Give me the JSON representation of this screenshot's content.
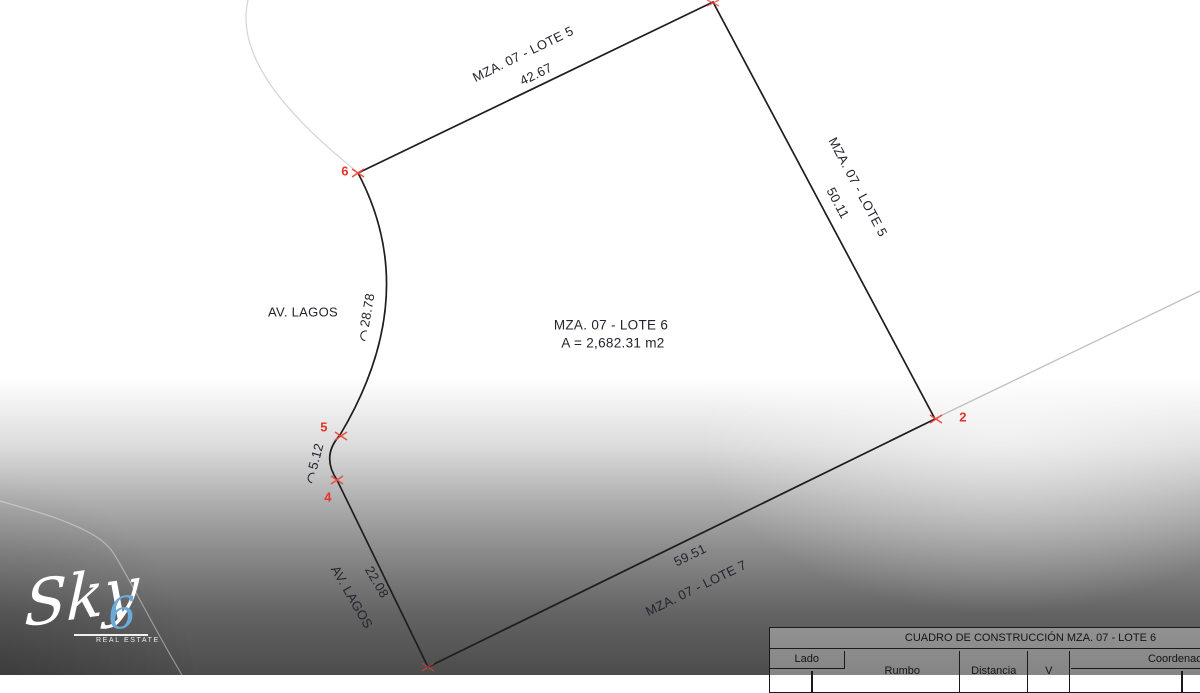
{
  "drawing": {
    "lot_title": "MZA. 07 - LOTE 6",
    "lot_area": "A = 2,682.31 m2",
    "top": {
      "neighbor": "MZA. 07 - LOTE 5",
      "length": "42.67"
    },
    "right": {
      "neighbor": "MZA. 07 - LOTE 5",
      "length": "50.11"
    },
    "bottom": {
      "neighbor": "MZA. 07 - LOTE 7",
      "length": "59.51"
    },
    "street_upper": "AV. LAGOS",
    "street_lower": "AV. LAGOS",
    "curve_length_upper": "28.78",
    "curve_length_lower": "5.12",
    "segment_length": "22.08",
    "vertices": {
      "v6": "6",
      "v5": "5",
      "v4": "4",
      "v2": "2"
    }
  },
  "table": {
    "title": "CUADRO DE CONSTRUCCIÓN MZA. 07 - LOTE 6",
    "columns": {
      "lado": "Lado",
      "rumbo": "Rumbo",
      "distancia": "Distancia",
      "v": "V",
      "coordenadas": "Coordenadas"
    }
  },
  "logo": {
    "brand": "Sky",
    "number": "6",
    "tagline": "REAL ESTATE"
  },
  "colors": {
    "boundary_line": "#1e1e1e",
    "faint_line": "#c9c9c9",
    "vertex_red": "#e5332b",
    "label_text": "#23232e",
    "logo_blue": "#6cabd9"
  }
}
